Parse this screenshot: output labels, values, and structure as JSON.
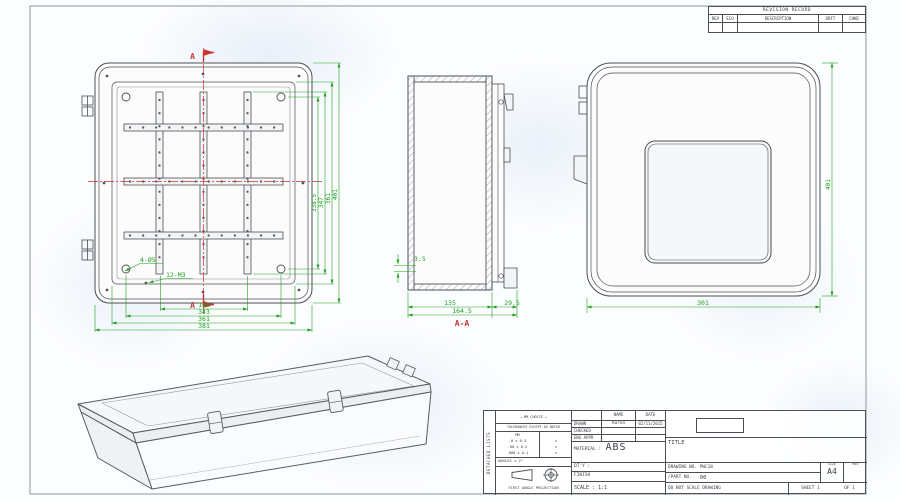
{
  "sheet": {
    "revision_table": {
      "title": "REVISION RECORD",
      "columns": [
        "REV",
        "ECO",
        "DESCRIPTION",
        "DRFT",
        "CHKD"
      ]
    },
    "title_block": {
      "side_label": "DETACHED LISTS",
      "units_note": "MM CHOICE",
      "tolerance_header": "TOLERANCES EXCEPT AS NOTED",
      "tolerance_unit": "MM",
      "tolerance_rows": [
        ".0 ± 0.3",
        ".00 ± 0.2",
        ".000 ± 0.1"
      ],
      "tolerance_inch_col": [
        "±",
        "±",
        "±"
      ],
      "angles_note": "ANGLES ± 2°",
      "projection_note": "FIRST ANGLE PROJECTION",
      "name_header": "NAME",
      "date_header": "DATE",
      "drawn_label": "DRAWN",
      "drawn_name": "Aaron",
      "drawn_date": "02/11/2015",
      "checked_label": "CHECKED",
      "eng_appr_label": "ENG APPR",
      "material_label": "MATERIAL :",
      "material_value": "ABS",
      "qty_label": "QT'Y :",
      "finish_label": "FINISH",
      "scale_label": "SCALE : 1:1",
      "title_label": "TITLE",
      "drawing_no_label": "DRAWING NO. PWC18",
      "part_no_label": "/PART NO.",
      "part_no_value": "00",
      "size_label": "SIZE",
      "size_value": "A4",
      "rev_label": "REV",
      "scale_note": "DO NOT SCALE DRAWING",
      "sheet_label": "SHEET 1",
      "sheet_of": "OF 1"
    },
    "views": {
      "front": {
        "section_marker_top": "A",
        "section_marker_bottom": "A",
        "hole_label_corner": "4-Ø5",
        "hole_label_rails": "12-M3",
        "dims_bottom": [
          "160",
          "343",
          "361",
          "381"
        ],
        "dims_right": [
          "338.5",
          "347",
          "361",
          "401"
        ]
      },
      "section": {
        "label": "A-A",
        "dim_depth_body": "135",
        "dim_depth_total": "164.5",
        "dim_lid": "29.5",
        "dim_wall": "3.5"
      },
      "back": {
        "dim_width": "301",
        "dim_height": "401"
      }
    }
  }
}
